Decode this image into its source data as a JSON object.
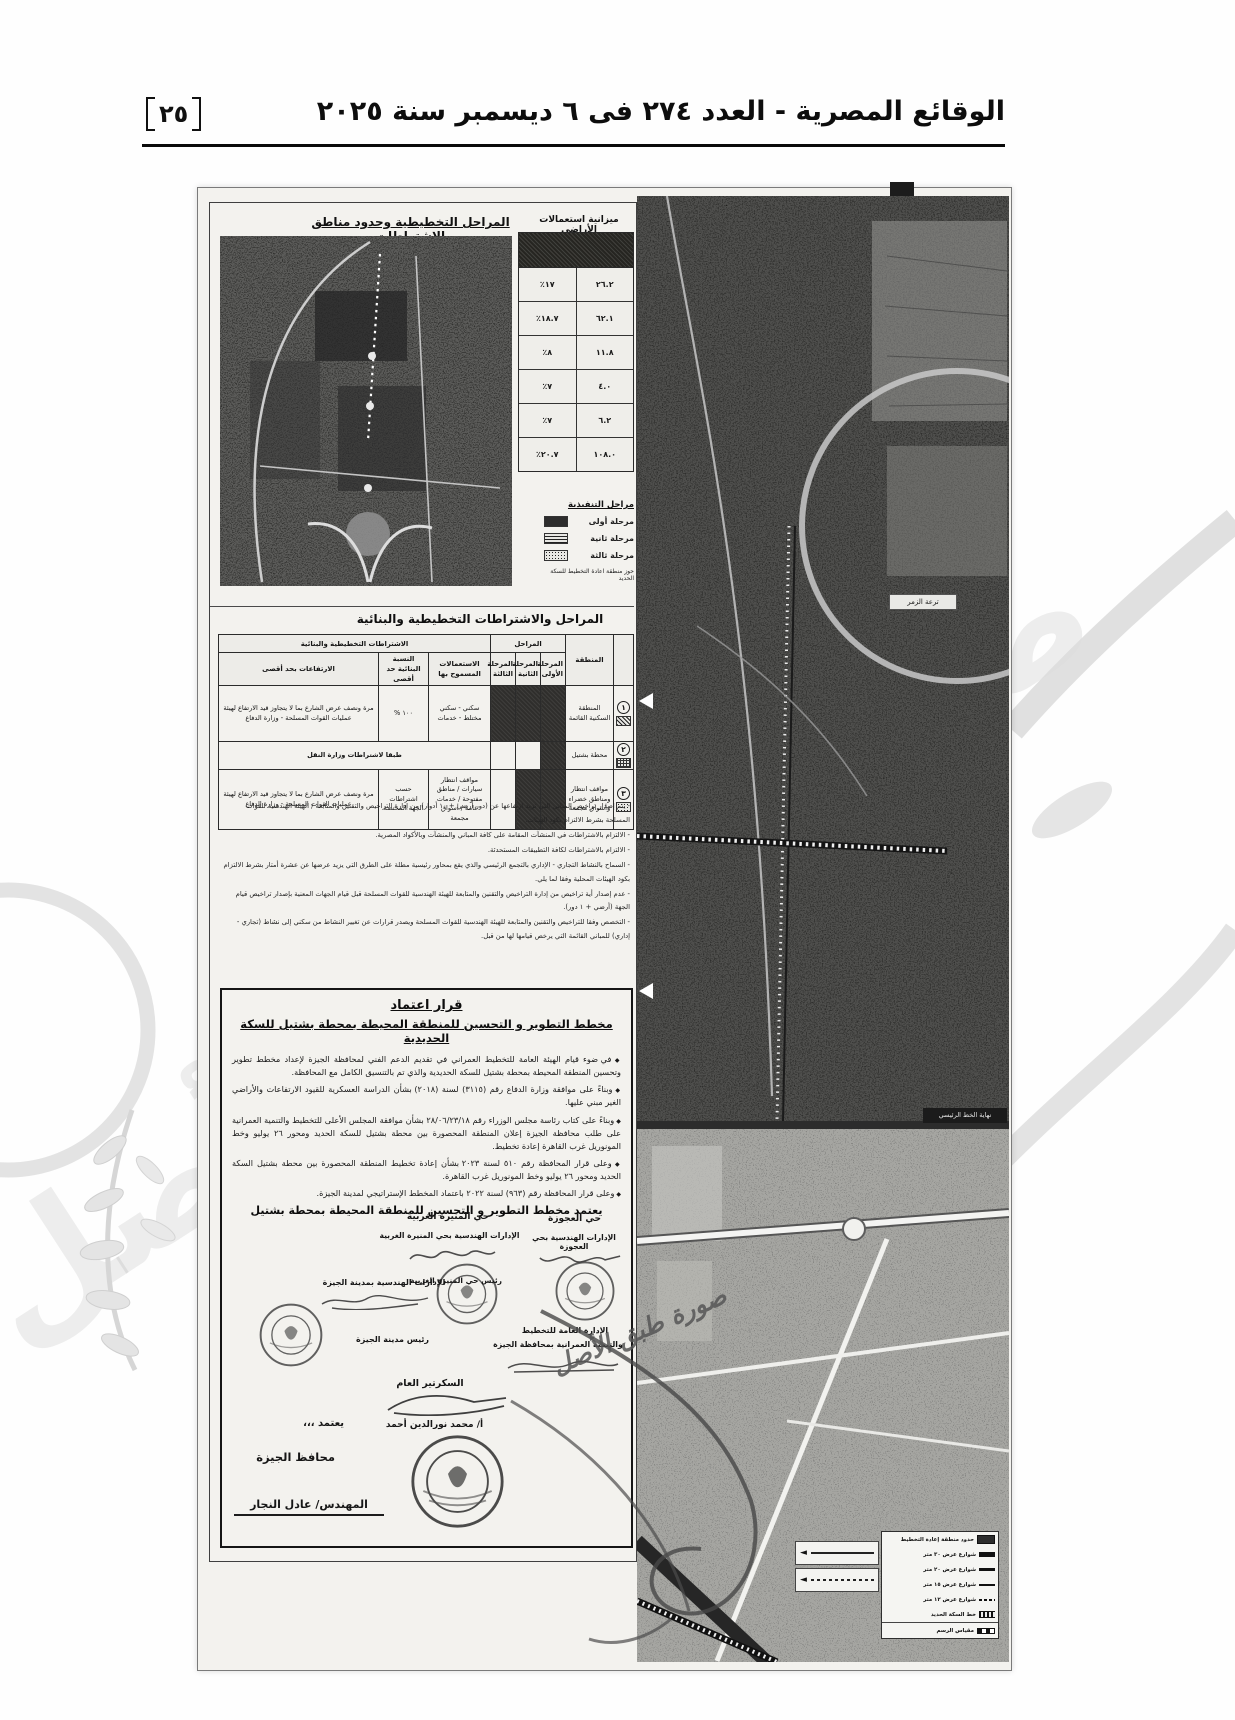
{
  "header": {
    "page_number": "٢٥",
    "issue_title": "الوقائع المصرية - العدد ٢٧٤ فى ٦ ديسمبر سنة ٢٠٢٥"
  },
  "plan_map": {
    "title": "المراحل التخطيطية وحدود مناطق الاشتراطات"
  },
  "land_use": {
    "title": "ميزانية استعمالات الأراضي",
    "rows": [
      {
        "area": "٢٦.٢",
        "percent": "١٧٪"
      },
      {
        "area": "٦٢.١",
        "percent": "١٨.٧٪"
      },
      {
        "area": "١١.٨",
        "percent": "٨٪"
      },
      {
        "area": "٤.٠",
        "percent": "٧٪"
      },
      {
        "area": "٦.٢",
        "percent": "٧٪"
      },
      {
        "area": "١٠٨.٠",
        "percent": "٢٠.٧٪"
      }
    ]
  },
  "phase_legend": {
    "title": "مراحل التنفيذية",
    "items": [
      {
        "label": "مرحلة أولى"
      },
      {
        "label": "مرحلة ثانية"
      },
      {
        "label": "مرحلة ثالثة"
      }
    ],
    "note": "حوز منطقة اعادة التخطيط للسكة الحديد"
  },
  "conditions": {
    "title": "المراحل والاشتراطات التخطيطية والبنائية",
    "headers": {
      "zone": "المنطقة",
      "phases_group": "المراحل",
      "requirements_group": "الاشتراطات التخطيطية والبنائية",
      "phase1": "المرحلة الأولى",
      "phase2": "المرحلة الثانية",
      "phase3": "المرحلة الثالثة",
      "uses": "الاستعمالات المسموح بها",
      "ratio": "النسبة البنائية حد أقصى",
      "heights": "الارتفاعات بحد أقصى"
    },
    "rows": [
      {
        "no": "١",
        "zone": "المنطقة السكنية القائمة",
        "uses": "سكني - سكني مختلط - خدمات",
        "ratio": "١٠٠ %",
        "heights": "مرة ونصف عرض الشارع بما لا يتجاوز قيد الارتفاع لهيئة عمليات القوات المسلحة - وزارة الدفاع"
      },
      {
        "no": "٢",
        "zone": "محطة بشتيل",
        "merged": "طبقا لاشتراطات وزارة النقل"
      },
      {
        "no": "٣",
        "zone": "مواقف انتظار ومناطق خضراء وأسواق مجمعة",
        "uses": "مواقف انتظار سيارات / مناطق مفتوحة / خدمات عامة / أسواق مجمعة",
        "ratio": "حسب اشتراطات الجهة المختصة",
        "heights": "مرة ونصف عرض الشارع بما لا يتجاوز قيد الارتفاع لهيئة عمليات القوات المسلحة - وزارة الدفاع"
      }
    ]
  },
  "notes": {
    "lines": [
      "- يتم إصدار تراخيص المباني التي تزيد ارتفاعها عن (دور أرضي + ١٠ أدوار) من إدارة التراخيص والتقنين والمتابعة / الهيئة الهندسية للقوات المسلحة بشرط الالتزام بكود الهيئات.",
      "- الالتزام بالاشتراطات في المنشآت المقامة على كافة المباني والمنشآت وبالأكواد المصرية.",
      "- الالتزام بالاشتراطات لكافة التطبيقات المستحدثة.",
      "- السماح بالنشاط التجاري - الإداري بالتجمع الرئيسي والذي يقع بمحاور رئيسية مطلة على الطرق التي يزيد عرضها عن عشرة أمتار بشرط الالتزام بكود الهيئات المحلية وفقا لما يلي.",
      "- عدم إصدار أية تراخيص من إدارة التراخيص والتقنين والمتابعة للهيئة الهندسية للقوات المسلحة قبل قيام الجهات المعنية بإصدار تراخيص قيام الجهة (أرضي + ١ دور).",
      "- التخصص وفقا للتراخيص والتقنين والمتابعة للهيئة الهندسية للقوات المسلحة ويصدر قرارات عن تغيير النشاط من سكني إلى نشاط (تجاري - إداري) للمباني القائمة التي يرخص قيامها لها من قبل."
    ]
  },
  "decree": {
    "title_line1": "قرار اعتماد",
    "title_line2": "مخطط التطوير و التحسين للمنطقة المحيطة بمحطة بشتيل للسكة الحديدية",
    "paragraphs": [
      "في ضوء قيام الهيئة العامة للتخطيط العمراني في تقديم الدعم الفني لمحافظة الجيزة لإعداد مخطط تطوير وتحسين المنطقة المحيطة بمحطة بشتيل للسكة الحديدية والذي تم بالتنسيق الكامل مع المحافظة.",
      "وبناءً على موافقة وزارة الدفاع رقم (٣١١٥) لسنة (٢٠١٨) بشأن الدراسة العسكرية للقيود الارتفاعات والأراضي الغير مبني عليها.",
      "وبناءً على كتاب رئاسة مجلس الوزراء رقم ٢٨/٠٦/٢٣/١٨ بشأن موافقة المجلس الأعلى للتخطيط والتنمية العمرانية على طلب محافظة الجيزة إعلان المنطقة المحصورة بين محطة بشتيل للسكة الحديد ومحور ٢٦ يوليو وخط المونوريل غرب القاهرة إعادة تخطيط.",
      "وعلى قرار المحافظة رقم ٥١٠ لسنة ٢٠٢٣ بشأن إعادة تخطيط المنطقة المحصورة بين محطة بشتيل السكة الحديد ومحور ٢٦ يوليو وخط المونوريل غرب القاهرة.",
      "وعلى قرار المحافظة رقم (٩٦٣) لسنة ٢٠٢٢ باعتماد المخطط الإستراتيجي لمدينة الجيزة."
    ],
    "approval_line": "يعتمد مخطط التطوير و التحسين للمنطقة المحيطة بمحطة بشتيل",
    "signatures": {
      "district_center": "حي المنيرة الغربية",
      "district_center_dept": "الإدارات الهندسية بحي المنيرة الغربية",
      "district_center_head": "رئيس حي المنيرة الغربية",
      "district_right": "حي العجوزة",
      "district_right_dept": "الإدارات الهندسية بحي العجوزة",
      "giza_city_dept": "الإدارات الهندسية بمدينة الجيزة",
      "giza_city_head": "رئيس مدينة الجيزة",
      "planning_dept_line1": "الإدارة العامة للتخطيط",
      "planning_dept_line2": "والتنمية العمرانية بمحافظة الجيزة",
      "secretary_title": "السكرتير العام",
      "secretary_name": "أ/ محمد نورالدين أحمد",
      "approve_word": "يعتمد ،،،",
      "governor_title": "محافظ الجيزة",
      "governor_name": "المهندس/ عادل النجار"
    }
  },
  "certified_stamp": "صورة طبق الأصل",
  "watermark_text": "صورة طبق الأصل",
  "right_map": {
    "label_top": "ترعة الزمر",
    "label_bottom": "نهاية الخط الرئيسي",
    "legend": {
      "rows": [
        "حدود منطقة إعادة التخطيط",
        "شوارع عرض ٣٠ متر",
        "شوارع عرض ٢٠ متر",
        "شوارع عرض ١٥ متر",
        "شوارع عرض ١٢ متر",
        "خط السكة الحديد"
      ],
      "scale": "مقياس الرسم"
    }
  }
}
